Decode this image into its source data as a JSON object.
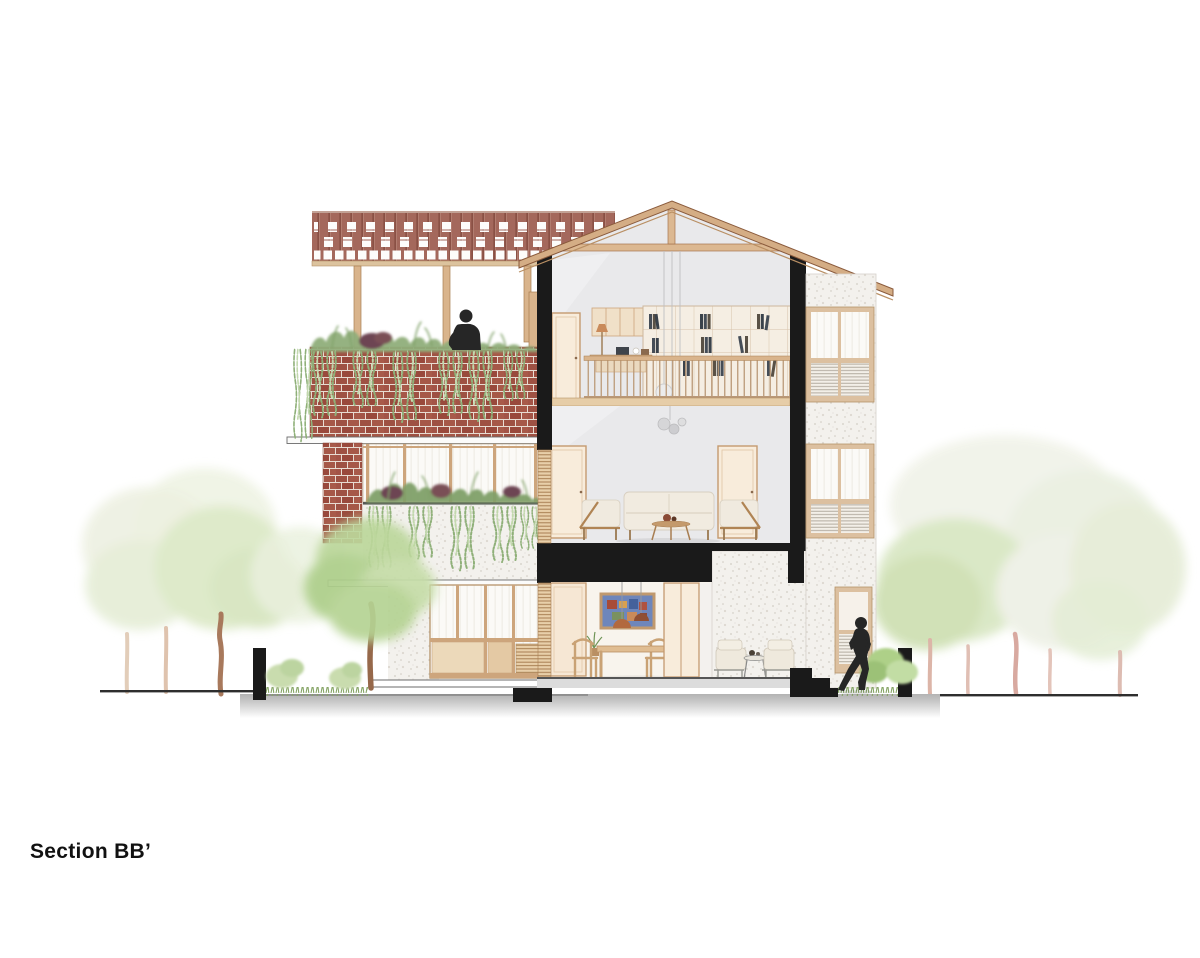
{
  "drawing": {
    "title": "Section BB’"
  },
  "palette": {
    "background": "#ffffff",
    "ink": "#111111",
    "cut_black": "#1a1a1a",
    "brick": "#9e5143",
    "brick_mortar": "#e8dcd2",
    "lattice_brick": "#a4685c",
    "wood_frame": "#cda57c",
    "wood_roof": "#d4ad85",
    "interior_gray": "#e9e9eb",
    "terrazzo": "#f3f1ed",
    "door_peach": "#f8ecdb",
    "foliage_bright": "#b5d393",
    "foliage_pale": "#e4ecd4",
    "vine_green": "#8fb079",
    "hedge_green": "#8fae7a",
    "shrub_maroon": "#6d4452",
    "cream_upholstery": "#f0eadf",
    "earth_gray": "#bdbdbd",
    "copper_lamp": "#b06a42",
    "painting_blue": "#6e86bb",
    "silhouette": "#262626"
  }
}
